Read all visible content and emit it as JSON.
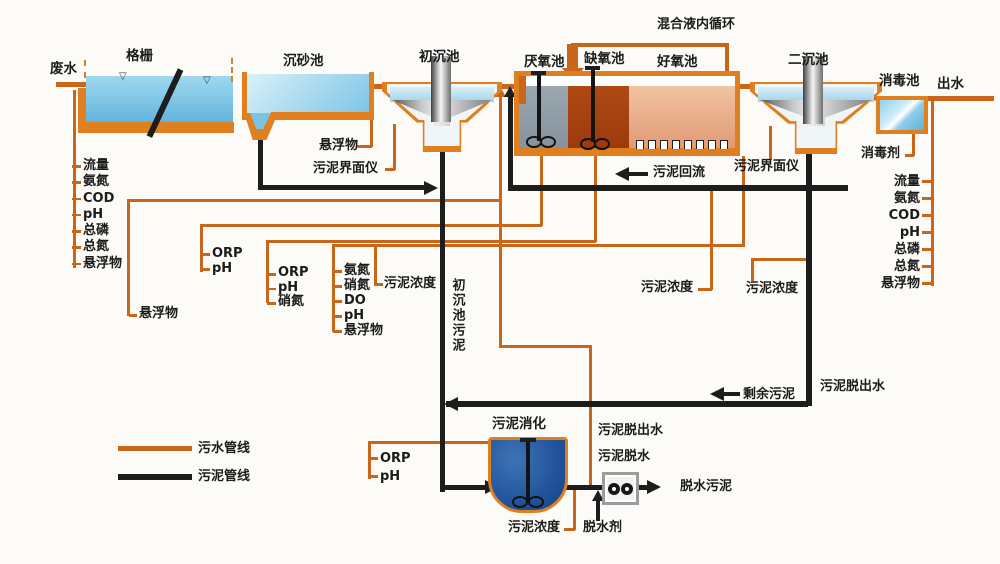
{
  "stages": {
    "influent": "废水",
    "bar_screen": "格栅",
    "grit_chamber": "沉砂池",
    "primary_clarifier": "初沉池",
    "anaerobic_tank": "厌氧池",
    "anoxic_tank": "缺氧池",
    "aerobic_tank": "好氧池",
    "secondary_clarifier": "二沉池",
    "disinfection_tank": "消毒池",
    "effluent": "出水",
    "sludge_digester": "污泥消化"
  },
  "streams": {
    "internal_recycle": "混合液内循环",
    "sludge_return": "污泥回流",
    "excess_sludge": "剩余污泥",
    "primary_sludge": "初沉池污泥",
    "dewatered_sludge": "脱水污泥",
    "filtrate_right": "污泥脱出水",
    "filtrate_mid": "污泥脱出水",
    "sludge_dewatering": "污泥脱水",
    "dewatering_agent": "脱水剂",
    "disinfectant": "消毒剂"
  },
  "instruments": {
    "influent_params": [
      "流量",
      "氨氮",
      "COD",
      "pH",
      "总磷",
      "总氮",
      "悬浮物"
    ],
    "effluent_params": [
      "流量",
      "氨氮",
      "COD",
      "pH",
      "总磷",
      "总氮",
      "悬浮物"
    ],
    "grit_outlet_ss": "悬浮物",
    "bioreactor_inlet_ss": "悬浮物",
    "primary_sludge_interface": "污泥界面仪",
    "secondary_sludge_interface": "污泥界面仪",
    "anaerobic_params": [
      "ORP",
      "pH"
    ],
    "anoxic_params": [
      "ORP",
      "pH",
      "硝氮"
    ],
    "aerobic_params": [
      "氨氮",
      "硝氮",
      "DO",
      "pH",
      "悬浮物"
    ],
    "aerobic_mlss": "污泥浓度",
    "return_sludge_mlss": "污泥浓度",
    "secondary_sludge_mlss": "污泥浓度",
    "digester_params": [
      "ORP",
      "pH"
    ],
    "digester_mlss": "污泥浓度"
  },
  "legend": {
    "sewage_line_label": "污水管线",
    "sludge_line_label": "污泥管线"
  },
  "colors": {
    "sewage_pipe": "#c9661a",
    "sludge_pipe": "#1d1d1d",
    "tank_border": "#df7f1f"
  }
}
